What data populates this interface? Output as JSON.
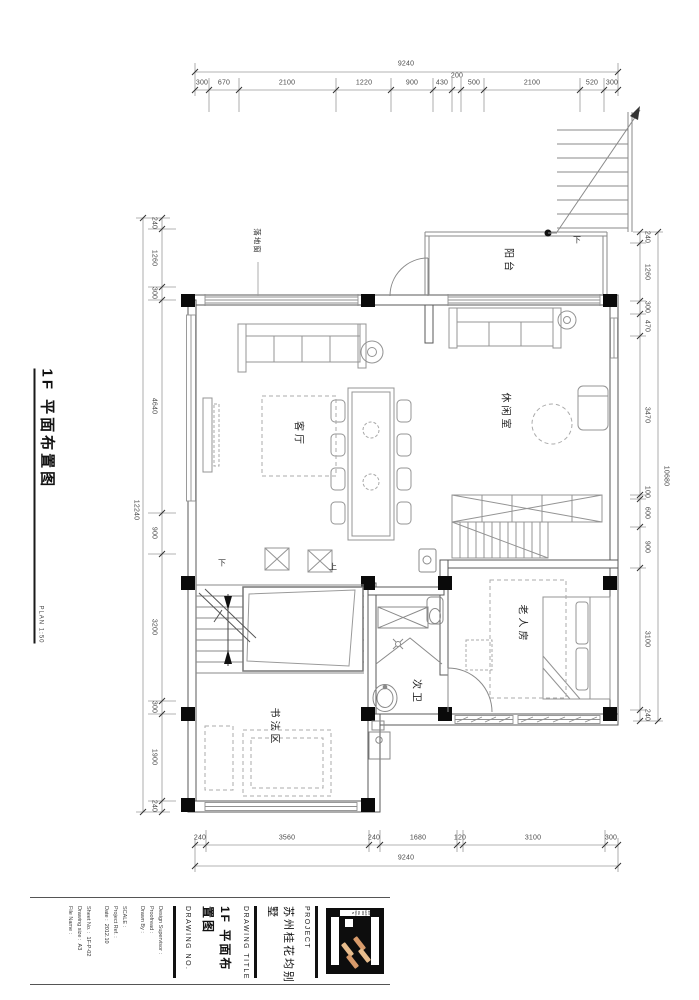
{
  "page": {
    "sheet_title": "1F 平面布置图",
    "scale_note": "PLAN  1:50"
  },
  "rooms": {
    "balcony": "阳台",
    "living": "客厅",
    "leisure": "休闲室",
    "elder": "老人房",
    "bath": "次卫",
    "calligraphy": "书法区"
  },
  "annotations": {
    "window_label": "落地窗",
    "stair_up": "上",
    "stair_down": "下",
    "balcony_stair_down": "下"
  },
  "dims": {
    "top": {
      "total": "9240",
      "segments": [
        "300",
        "670",
        "2100",
        "1220",
        "900",
        "430",
        "200",
        "500",
        "2100",
        "520",
        "300"
      ]
    },
    "bottom": {
      "total": "9240",
      "segments": [
        "240",
        "3560",
        "240",
        "1680",
        "120",
        "3100",
        "300"
      ]
    },
    "left": {
      "total": "12240",
      "segments": [
        "240",
        "1260",
        "300",
        "4640",
        "900",
        "3200",
        "300",
        "1900",
        "240"
      ]
    },
    "right": {
      "total": "10680",
      "segments": [
        "240",
        "1260",
        "300",
        "470",
        "3470",
        "100",
        "600",
        "900",
        "3100",
        "240"
      ]
    }
  },
  "titleblock": {
    "project_label": "PROJECT",
    "project_name": "苏州桂花均别墅",
    "drawing_title_label": "DRAWING TITLE",
    "drawing_title": "1F 平面布置图",
    "drawing_no_label": "DRAWING NO.",
    "logo_text": "INTERIOR DESIGN",
    "fields": [
      {
        "label": "Design Supervisor :",
        "value": ""
      },
      {
        "label": "Proofread :",
        "value": ""
      },
      {
        "label": "Drawn By :",
        "value": ""
      },
      {
        "label": "SCALE :",
        "value": ""
      },
      {
        "label": "Project Ref. :",
        "value": ""
      },
      {
        "label": "Date :",
        "value": "2012.10"
      },
      {
        "label": "Sheet No. :",
        "value": "1F-P-02"
      },
      {
        "label": "Drawing size :",
        "value": "A3"
      },
      {
        "label": "File Name :",
        "value": ""
      }
    ]
  }
}
